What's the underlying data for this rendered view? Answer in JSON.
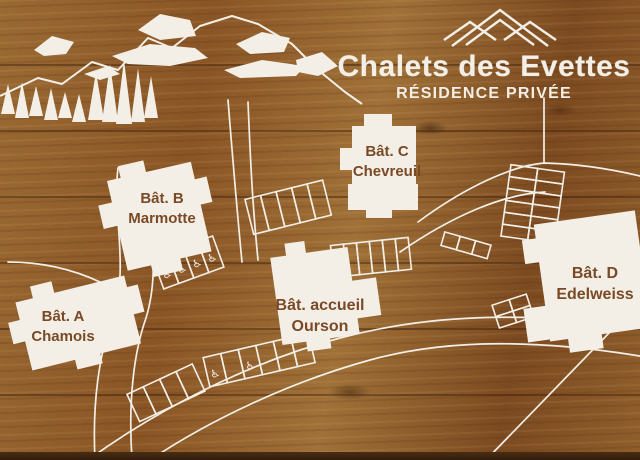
{
  "sign": {
    "title": "Chalets des Evettes",
    "subtitle": "RÉSIDENCE PRIVÉE"
  },
  "buildings": [
    {
      "name": "Bât. A",
      "subname": "Chamois"
    },
    {
      "name": "Bât. B",
      "subname": "Marmotte"
    },
    {
      "name": "Bât. C",
      "subname": "Chevreuil"
    },
    {
      "name": "Bât. D",
      "subname": "Edelweiss"
    },
    {
      "name": "Bât. accueil",
      "subname": "Ourson"
    }
  ],
  "icons": {
    "mountain_logo": "three-peaks-outline",
    "mountain_skyline": "mountain-ridge-with-snow",
    "pine_tree": "pine-tree",
    "accessible_parking_glyph": "♿"
  },
  "accessible_parking_spots": {
    "row_near_batiment_b": 4,
    "row_lower_parking": 2
  },
  "colors": {
    "wood_base": "#8f5e2b",
    "wood_dark": "#5f3a17",
    "artwork_white": "#f3efe7",
    "label_text_brown": "#7a4a26",
    "sign_edge_dark": "#2e1c0d"
  }
}
